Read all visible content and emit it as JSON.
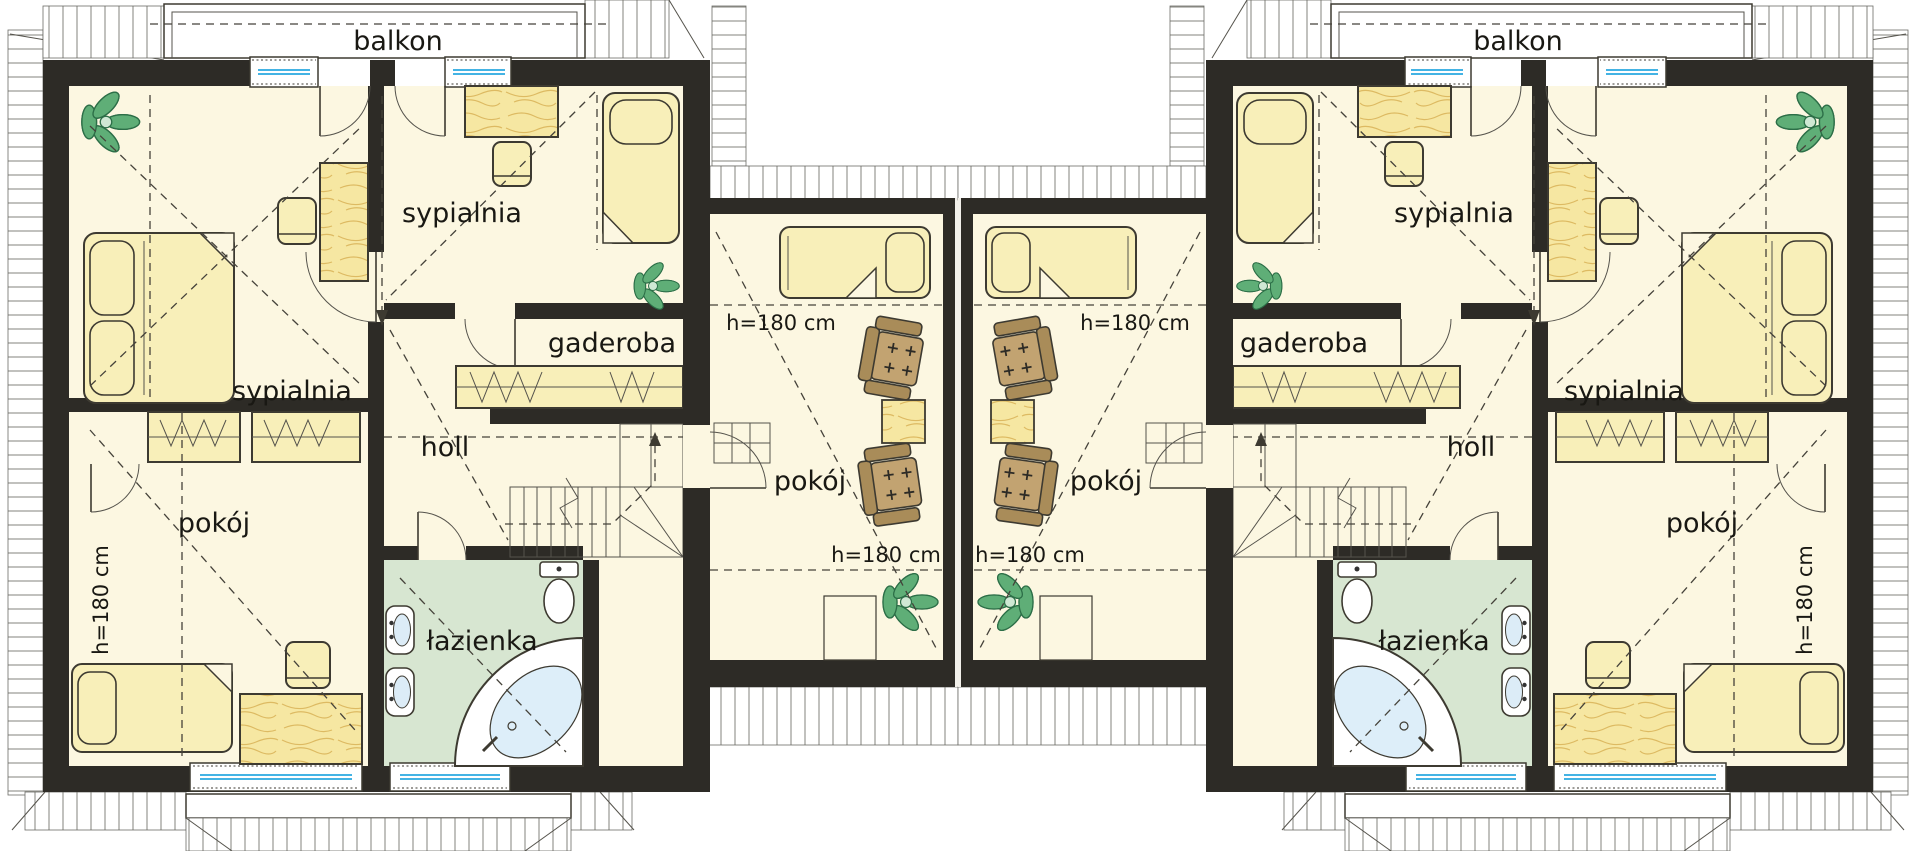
{
  "floor_plan": {
    "type": "attic-storey floor plan, mirrored twin units",
    "room_labels": {
      "balcony": "balkon",
      "bedroom": "sypialnia",
      "dressing_room": "gaderoba",
      "hall": "holl",
      "room": "pokój",
      "bathroom": "łazienka"
    },
    "height_annotation": "h=180 cm",
    "units": {
      "left_unit": {
        "balcony": "balkon",
        "rooms": [
          "sypialnia",
          "sypialnia",
          "gaderoba",
          "holl",
          "pokój",
          "łazienka"
        ],
        "height_notes": [
          "h=180 cm"
        ]
      },
      "middle_left_room": {
        "rooms": [
          "pokój"
        ],
        "height_notes": [
          "h=180 cm",
          "h=180 cm"
        ]
      },
      "middle_right_room": {
        "rooms": [
          "pokój"
        ],
        "height_notes": [
          "h=180 cm",
          "h=180 cm"
        ]
      },
      "right_unit": {
        "balcony": "balkon",
        "rooms": [
          "sypialnia",
          "sypialnia",
          "gaderoba",
          "holl",
          "pokój",
          "łazienka"
        ],
        "height_notes": [
          "h=180 cm"
        ]
      }
    },
    "colors": {
      "wall": "#2d2b26",
      "floor": "#fcf7e1",
      "bathroom": "#d7e6d1",
      "furniture": "#f8efb9",
      "wood": "#f6e7a2",
      "plant": "#5fae77",
      "window_glass": "#29a8e0",
      "line": "#3d3a31",
      "roof_hatch": "#83837d"
    }
  }
}
